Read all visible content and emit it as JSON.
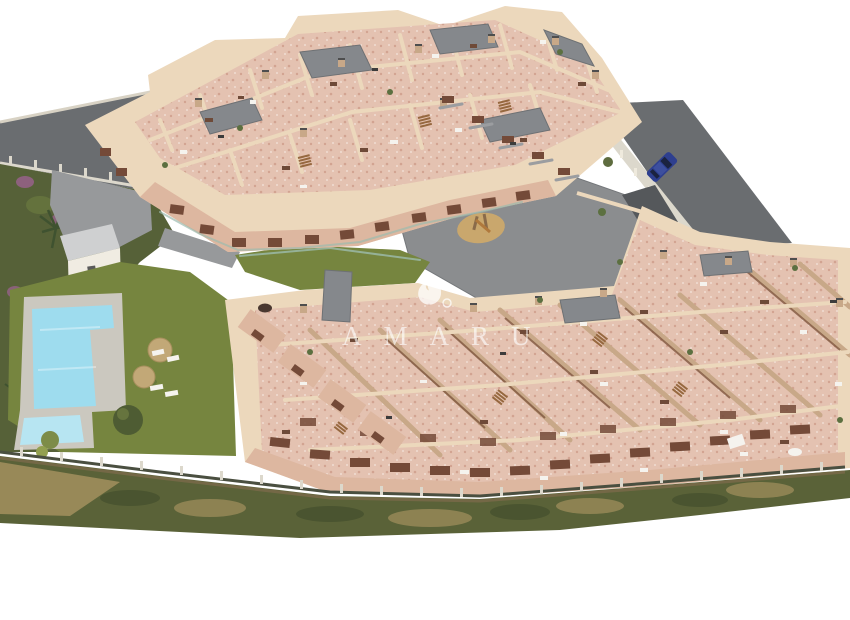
{
  "scene": {
    "type": "3d-architectural-aerial-render",
    "description": "Aerial 3D render of a terraced Mediterranean apartment complex with rooftop terraces, communal pool, lawns, playground courtyard and perimeter roads",
    "watermark": {
      "text": "AMARU",
      "icon": "flame-ring-logo"
    }
  },
  "colors": {
    "background": "#ffffff",
    "wall_cream": "#ecd8bc",
    "wall_tan": "#c8a888",
    "facade_pink": "#ddb7a0",
    "balcony_brown": "#744a38",
    "terrace_terracotta": "#e4c2b1",
    "terracotta_speckle": "#d2a391",
    "terracotta_light": "#f0ddd2",
    "roof_gray": "#85888c",
    "courtyard_gray": "#8b8d8f",
    "ramp_gray": "#55585b",
    "walkway_gray": "#97999b",
    "road_gray": "#6a6d70",
    "lawn_green": "#76853f",
    "hedge_green": "#566138",
    "scrub_green": "#5a6238",
    "scrub_dark": "#46512e",
    "scrub_dry": "#a3905e",
    "pool_deck": "#cbc8bf",
    "pool_water": "#9edcee",
    "kids_pool_water": "#b7e5f2",
    "pool_house_roof": "#cfd0d1",
    "pool_house_wall": "#f0ece2",
    "playground_sand": "#c9a76d",
    "umbrella_straw": "#c2a877",
    "fence_light": "#dcd8cc",
    "fence_dark": "#4a4f40",
    "glass_teal": "#9dbbae",
    "car_blue": "#2e3f8f",
    "car_roof": "#3d4f9e",
    "car_glass": "#1b2340",
    "furniture_white": "#f5f3ee",
    "furniture_brown": "#6e4a38",
    "furniture_dark": "#3c3c3c",
    "plant_green": "#5c7040",
    "palm_green": "#3f5230",
    "flower_purple": "#96628a",
    "watermark_white": "#ffffff"
  }
}
